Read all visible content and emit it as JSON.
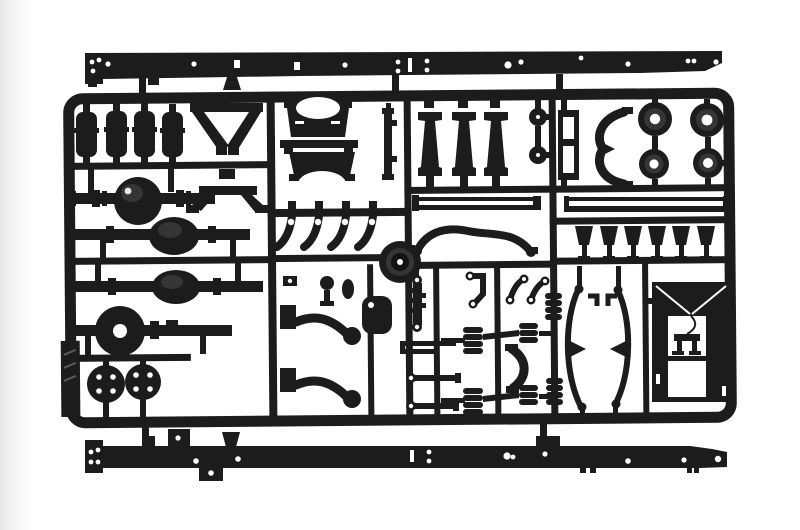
{
  "scene": {
    "type": "photograph",
    "subject": "Injection-molded black polystyrene model kit sprue with 1/24 truck chassis parts on a white studio background",
    "palette": {
      "background": "#ffffff",
      "vignette": "#e6e6e6",
      "plastic": "#1c1c1c",
      "plastic_deep": "#121212",
      "detail": "#353535",
      "sheen": "#474747",
      "spec": "#e8e8e8",
      "hole": "#ffffff",
      "mold_mark": "#5a5a5a"
    },
    "parts": {
      "top_rail": "long chassis side rail with rivet holes",
      "bottom_rail": "long chassis side rail with rivet holes and brackets",
      "sprue_frame": "rectangular sprue runner frame with internal runners",
      "shock_cylinders": "four shock-absorber cylinders",
      "v_braces": "two V-shaped support brackets",
      "axle_banjo": "axle housing with spherical differential",
      "axle_bulb_1": "rear axle housing with teardrop differential",
      "axle_bulb_2": "second rear axle housing with teardrop differential",
      "axle_front": "front axle beam with open differential ring",
      "hub_flanges": "two round hub flanges with four bolt holes each",
      "saddle_crossmembers": "two arched saddle cross-members",
      "vertical_strip": "thin vertical strip part",
      "shackle_hooks": "four curved shackle brackets with pivot holes",
      "center_drum": "round brake drum molded at runner junction",
      "crossmember_webs": "three hourglass-profile frame cross-members",
      "pulleys": "two small pulley discs",
      "tie_rods": "pair of long tie rods",
      "sway_bar": "curved anti-roll bar",
      "ladder_bracket": "small ladder-shaped bracket",
      "curved_bracket": "curved mounting bracket with pointer",
      "brake_drums": "four brake drum discs with centre holes",
      "thin_channel": "long thin channel rail",
      "spring_hangers": "six tapered spring hanger blocks",
      "leaf_springs": "two long bowed leaf springs with centre clamps",
      "rear_panel": "rectangular rear panel with diagonal braces and seat bracket",
      "air_bellows": "six ribbed air-suspension bellows",
      "torque_arms": "two curved torque arms with round pads",
      "tank_pot": "small rounded tank pot",
      "linkages": "assorted small links, levers and eye-rods",
      "mold_tab": "thick molded tab with mold marks on left frame edge"
    }
  }
}
